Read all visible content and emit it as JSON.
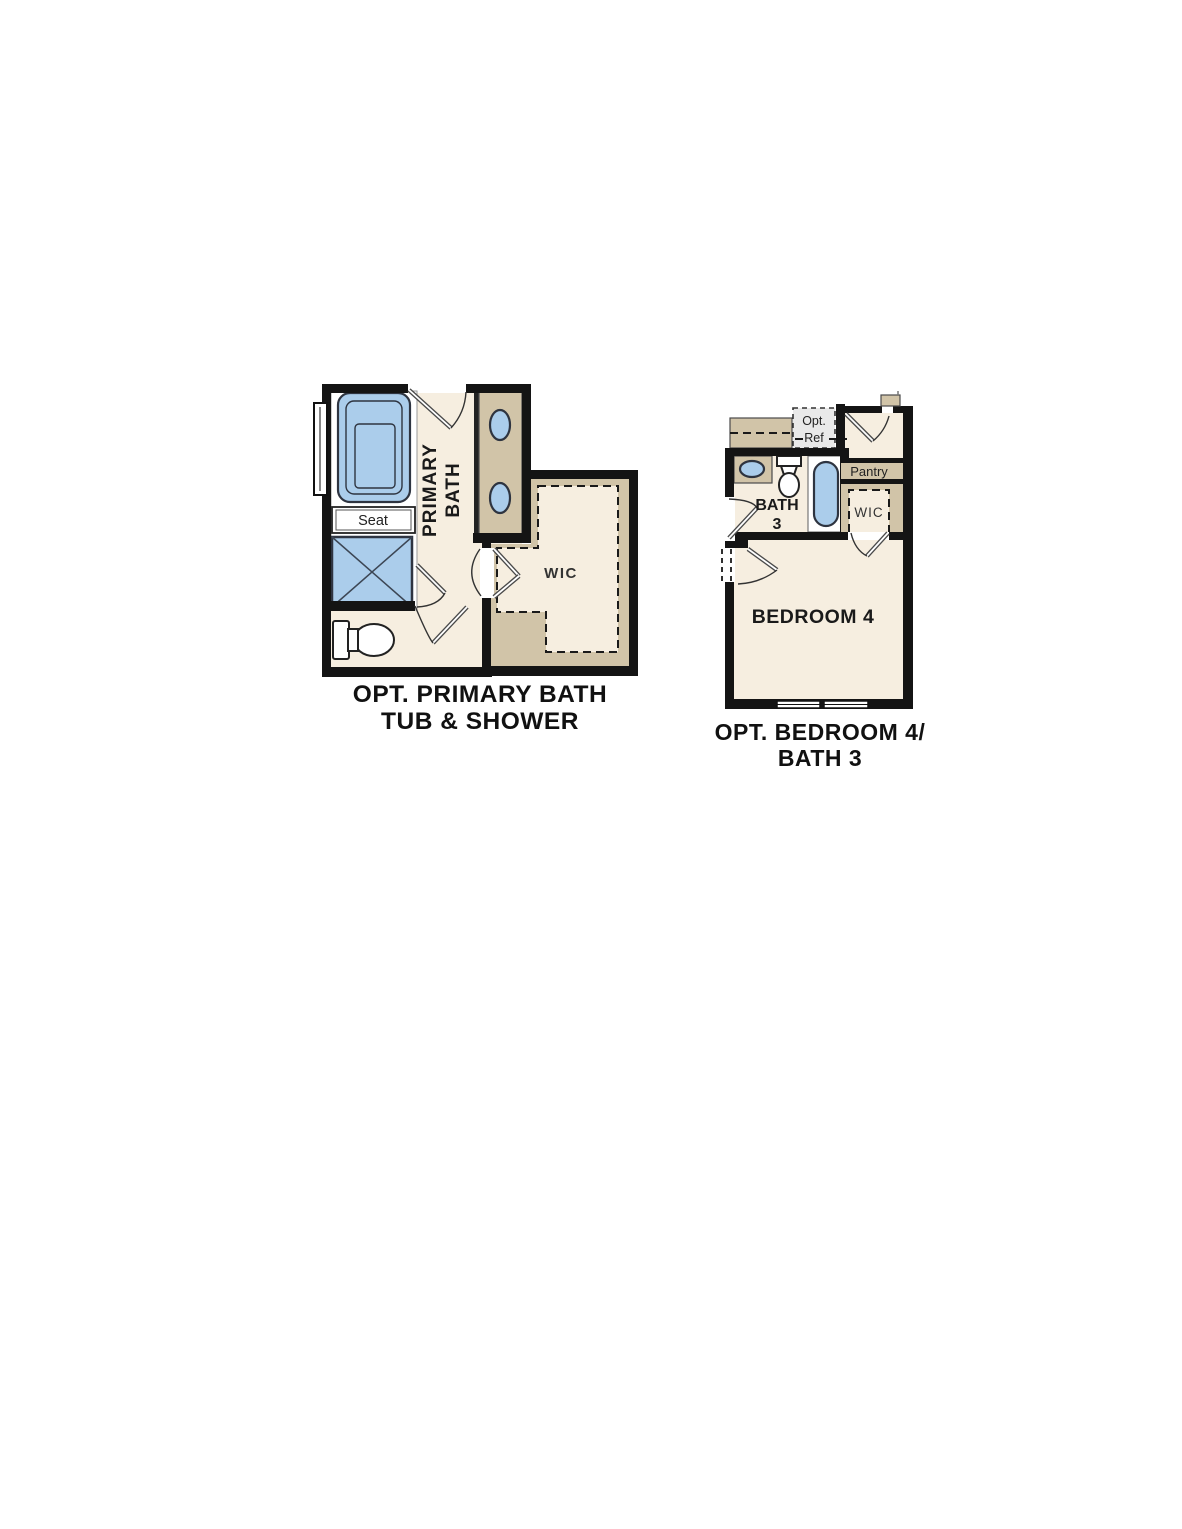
{
  "colors": {
    "floor_cream": "#f6eee0",
    "cabinet_tan": "#d1c4a8",
    "fixture_blue": "#abcdeb",
    "wall_black": "#141414",
    "opt_ref_gray": "#e9e9e9",
    "text_black": "#111111"
  },
  "left_plan": {
    "caption_line1": "OPT. PRIMARY BATH",
    "caption_line2": "TUB & SHOWER",
    "room_label_line1": "PRIMARY",
    "room_label_line2": "BATH",
    "seat_label": "Seat",
    "wic_label": "WIC"
  },
  "right_plan": {
    "caption_line1": "OPT. BEDROOM 4/",
    "caption_line2": "BATH 3",
    "opt_ref_line1": "Opt.",
    "opt_ref_line2": "Ref",
    "pantry_label": "Pantry",
    "bath_label_line1": "BATH",
    "bath_label_line2": "3",
    "wic_label": "WIC",
    "bedroom_label": "BEDROOM 4"
  }
}
